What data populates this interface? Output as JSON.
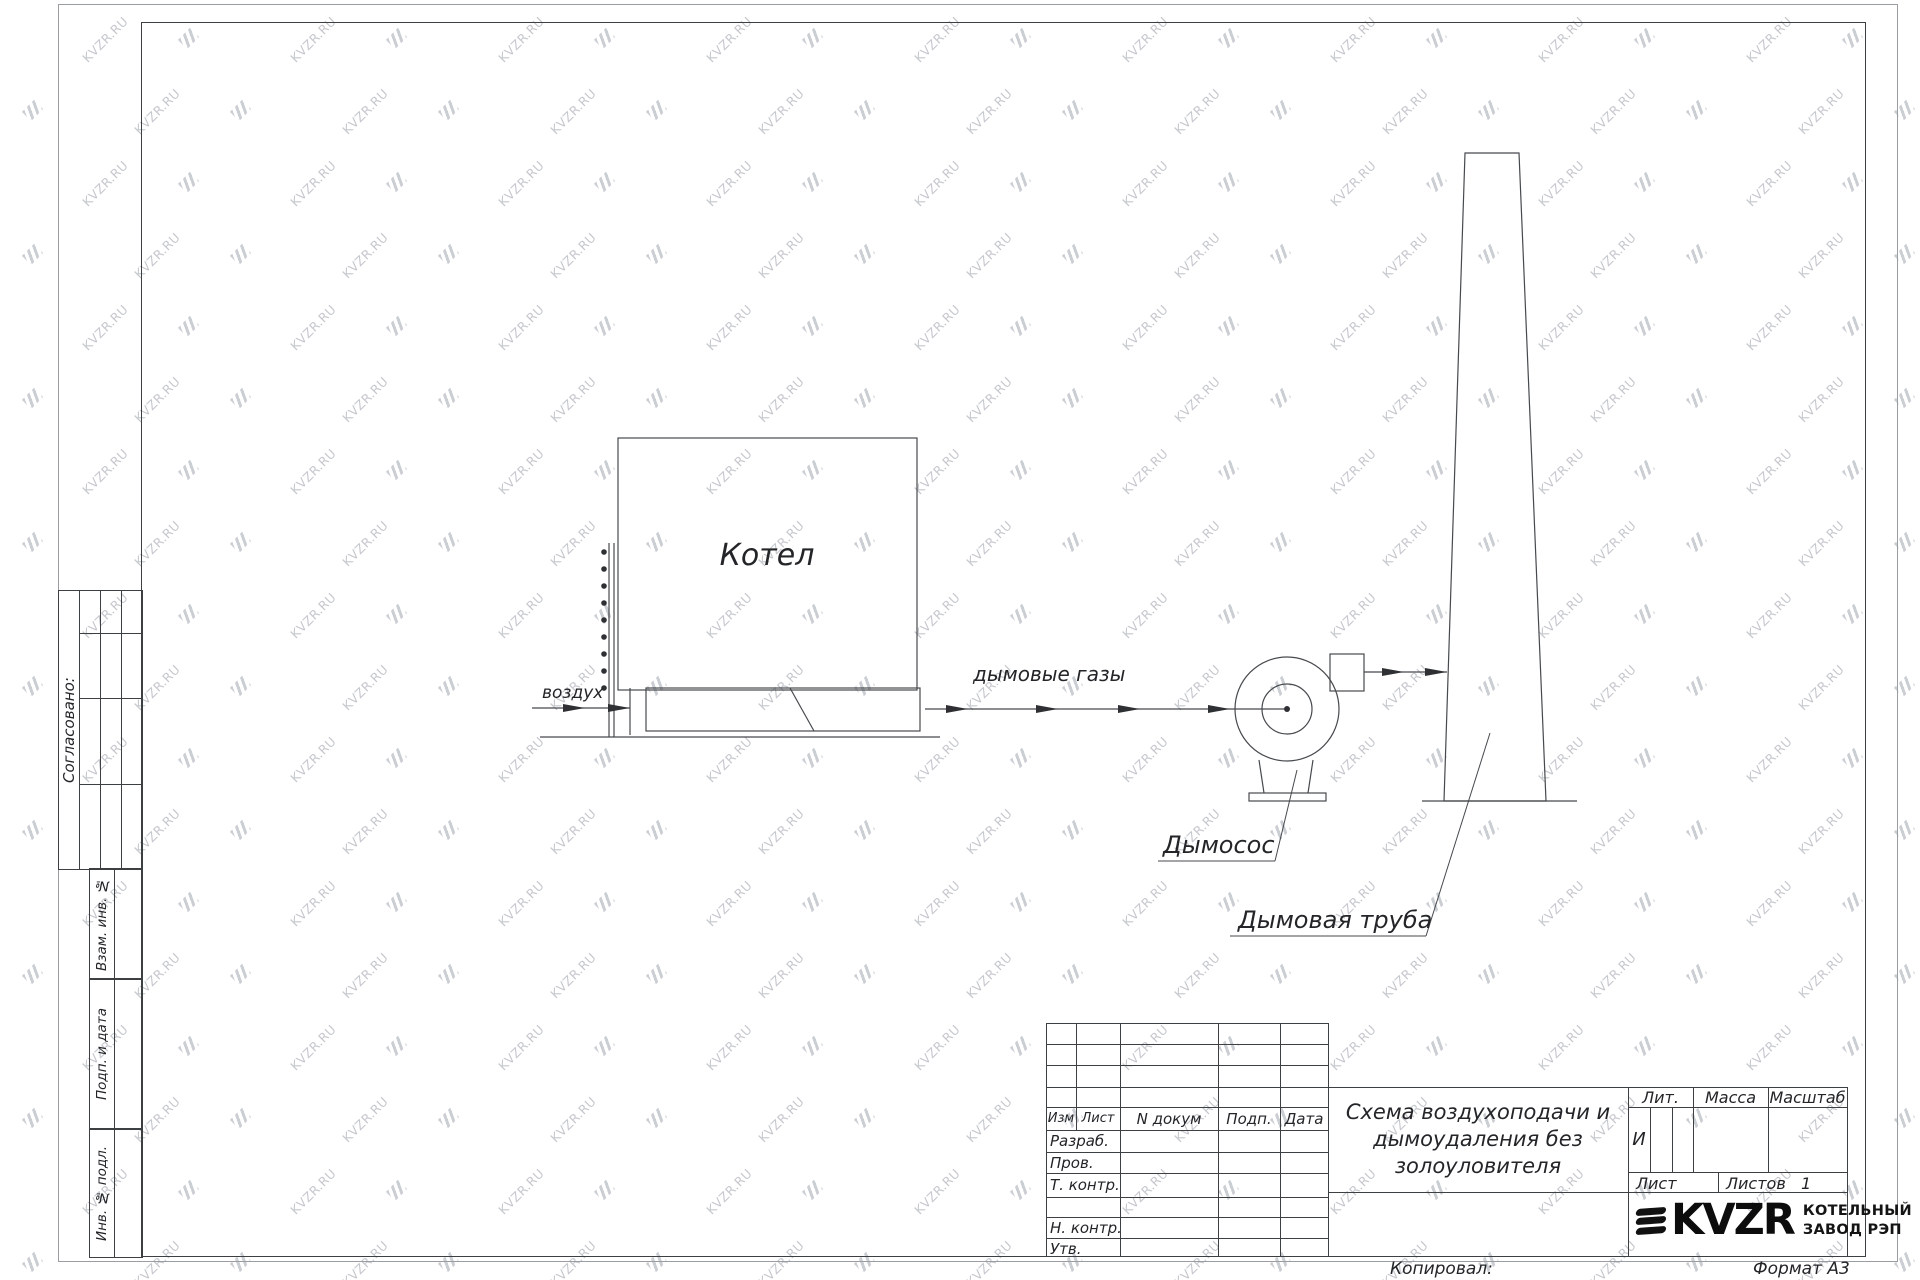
{
  "watermark": {
    "text": "KVZR.RU"
  },
  "margin": {
    "soglasovano": "Согласовано:",
    "vzam_inv": "Взам. инв. №",
    "podp_i_data": "Подп. и дата",
    "inv_podl": "Инв. № подл."
  },
  "diagram": {
    "boiler": "Котел",
    "air": "воздух",
    "flue_gases": "дымовые газы",
    "fan": "Дымосос",
    "chimney": "Дымовая труба"
  },
  "titleblock": {
    "cols": {
      "izm": "Изм",
      "list": "Лист",
      "n_dokum": "N докум",
      "podp": "Подп.",
      "data": "Дата"
    },
    "rows": {
      "razrab": "Разраб.",
      "prov": "Пров.",
      "t_kontr": "Т. контр.",
      "n_kontr": "Н. контр.",
      "utv": "Утв."
    },
    "title_line1": "Схема воздухоподачи и",
    "title_line2": "дымоудаления без",
    "title_line3": "золоуловителя",
    "lit": "Лит.",
    "massa": "Масса",
    "masshtab": "Масштаб",
    "lit_value": "И",
    "list": "Лист",
    "listov": "Листов",
    "listov_value": "1",
    "logo": "KVZR",
    "company1": "КОТЕЛЬНЫЙ",
    "company2": "ЗАВОД РЭП",
    "kopiroval": "Копировал:",
    "format": "Формат А3"
  }
}
